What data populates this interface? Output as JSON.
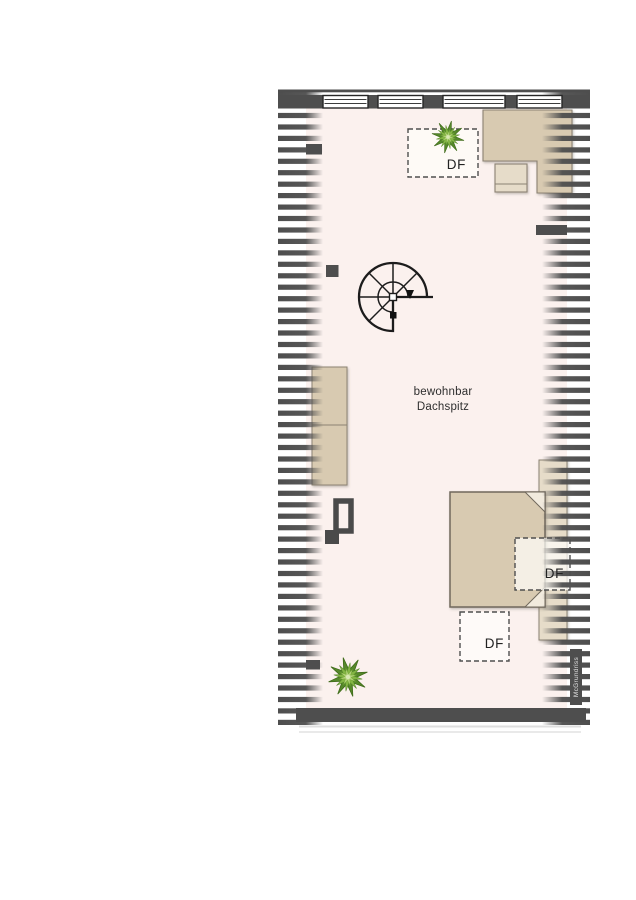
{
  "floorplan": {
    "room_label": {
      "line1": "bewohnbar",
      "line2": "Dachspitz"
    },
    "skylights": [
      {
        "label": "DF"
      },
      {
        "label": "DF"
      },
      {
        "label": "DF"
      }
    ],
    "watermark": "McGrundriss",
    "colors": {
      "wall": "#4e4e4e",
      "floor": "#fbf1ee",
      "furniture": "#d8cab1",
      "furniture_light": "#e6dcc9",
      "furniture_outline": "#8b8273",
      "stair": "#1c1c1c",
      "dash": "#4f4f4f",
      "plant_dark": "#4c7a1f",
      "plant_mid": "#6fa230",
      "plant_light": "#a4cc62",
      "text": "#2e2e2e"
    }
  }
}
